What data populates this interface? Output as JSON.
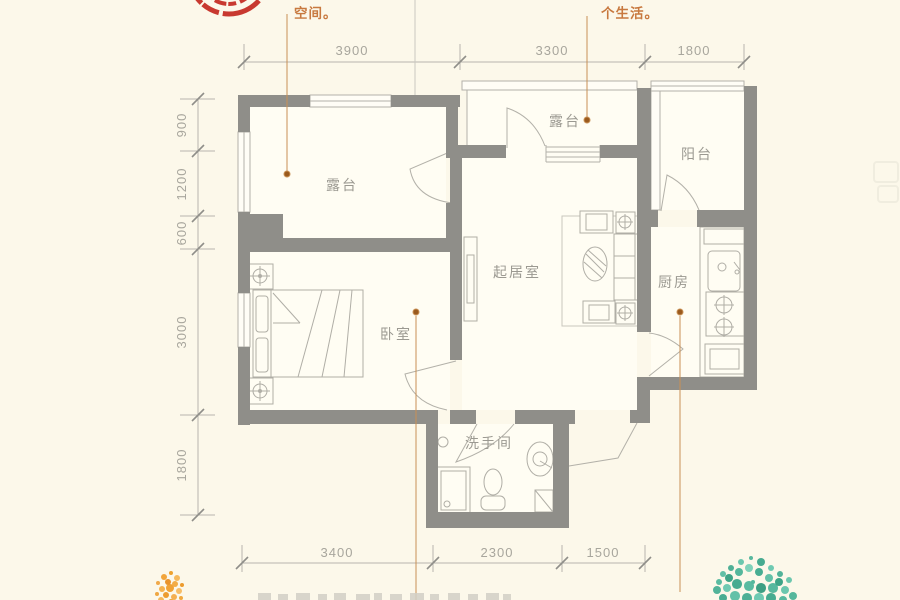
{
  "annotations": {
    "top_left": "空间。",
    "top_right": "个生活。"
  },
  "rooms": {
    "terrace_left": "露台",
    "terrace_top": "露台",
    "balcony": "阳台",
    "living": "起居室",
    "kitchen": "厨房",
    "bedroom": "卧室",
    "bathroom": "洗手间"
  },
  "dimensions": {
    "top": [
      "3900",
      "3300",
      "1800"
    ],
    "left": [
      "900",
      "1200",
      "600",
      "3000",
      "1800"
    ],
    "bottom": [
      "3400",
      "2300",
      "1500"
    ]
  },
  "colors": {
    "background": "#fcf8ea",
    "wall": "#8f8e89",
    "thin_line": "#b3b1a9",
    "dim_text": "#a8a69d",
    "room_text": "#9b9991",
    "accent_text": "#c8793f",
    "leader": "#c89055",
    "stamp_red": "#c3251c",
    "foliage_orange": "#f0a235",
    "foliage_teal": "#55b79c"
  }
}
